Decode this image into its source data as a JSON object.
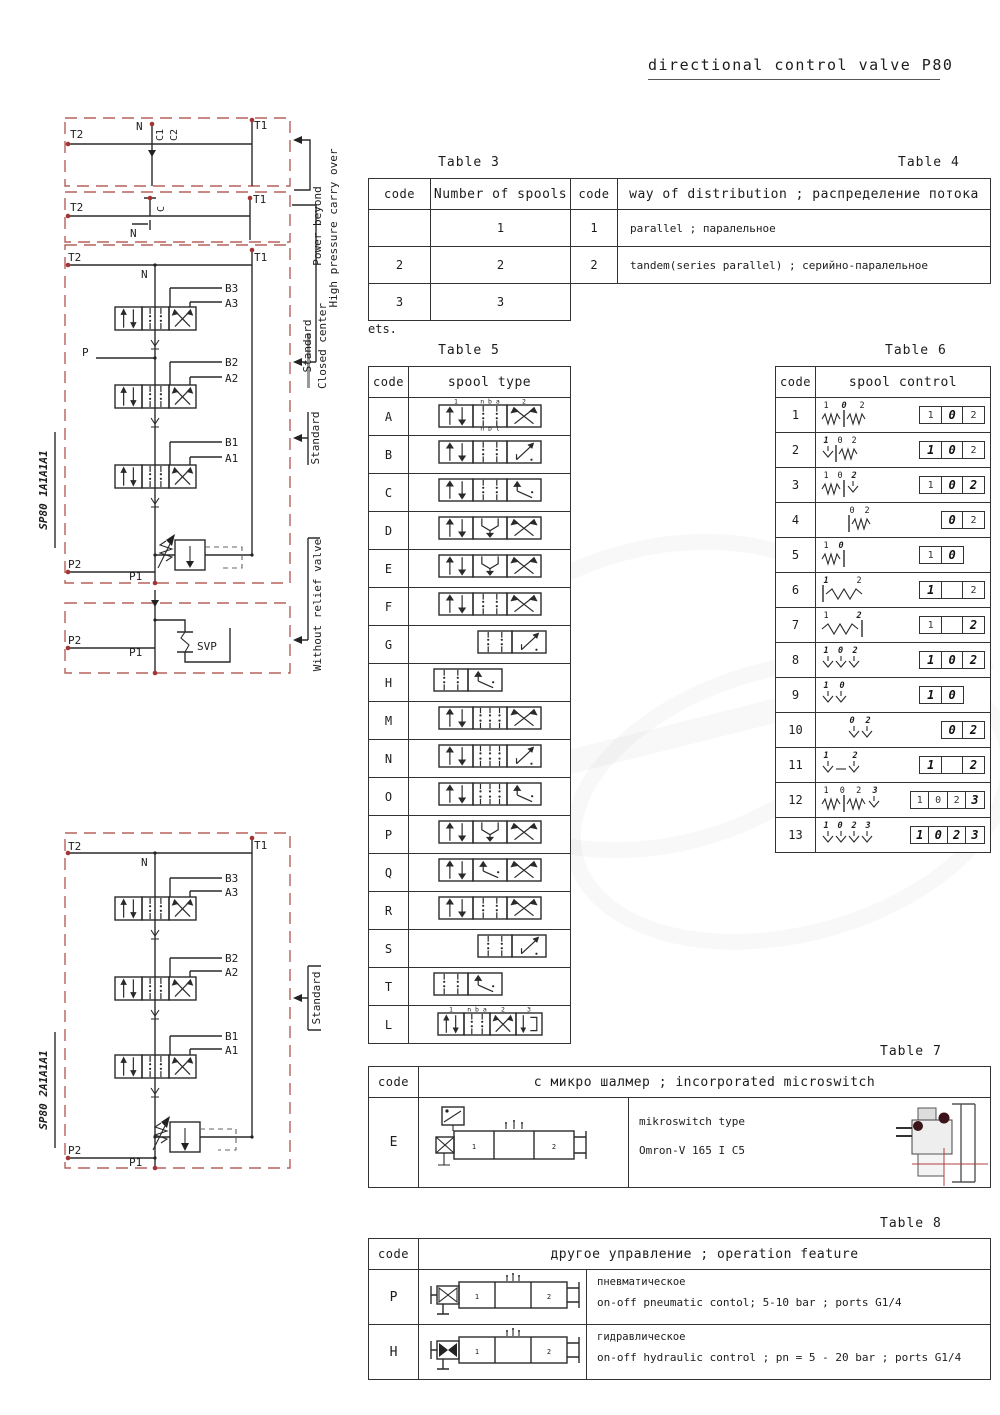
{
  "title": "directional control valve P80",
  "tables": {
    "t3": {
      "label": "Table 3",
      "headers": [
        "code",
        "Number of spools"
      ],
      "rows": [
        [
          "",
          "1"
        ],
        [
          "2",
          "2"
        ],
        [
          "3",
          "3"
        ]
      ],
      "note": "ets."
    },
    "t4": {
      "label": "Table 4",
      "headers": [
        "code",
        "way of distribution ; распределение потока"
      ],
      "rows": [
        [
          "1",
          "parallel ; паралельное"
        ],
        [
          "2",
          "tandem(series parallel) ; серийно-паралельное"
        ]
      ]
    },
    "t5": {
      "label": "Table 5",
      "headers": [
        "code",
        "spool type"
      ],
      "rows": [
        {
          "code": "A",
          "cells": [
            "P",
            "O",
            "X"
          ],
          "top": [
            "1",
            "n b a",
            "2"
          ],
          "bottom": [
            "",
            "n p t",
            ""
          ]
        },
        {
          "code": "B",
          "cells": [
            "P",
            "O",
            "Z"
          ]
        },
        {
          "code": "C",
          "cells": [
            "P",
            "O",
            "N"
          ]
        },
        {
          "code": "D",
          "cells": [
            "P",
            "U",
            "X"
          ]
        },
        {
          "code": "E",
          "cells": [
            "P",
            "U",
            "X"
          ]
        },
        {
          "code": "F",
          "cells": [
            "P",
            "O",
            "X"
          ]
        },
        {
          "code": "G",
          "cells": [
            "O",
            "Z"
          ],
          "offset": 1
        },
        {
          "code": "H",
          "cells": [
            "O",
            "N"
          ],
          "offset": -1
        },
        {
          "code": "M",
          "cells": [
            "P",
            "O6",
            "X"
          ]
        },
        {
          "code": "N",
          "cells": [
            "P",
            "O6",
            "Z"
          ]
        },
        {
          "code": "O",
          "cells": [
            "P",
            "O6",
            "N"
          ]
        },
        {
          "code": "P",
          "cells": [
            "P",
            "U",
            "X"
          ]
        },
        {
          "code": "Q",
          "cells": [
            "P",
            "N",
            "X"
          ]
        },
        {
          "code": "R",
          "cells": [
            "P",
            "O",
            "X"
          ]
        },
        {
          "code": "S",
          "cells": [
            "O",
            "Z"
          ],
          "offset": 1
        },
        {
          "code": "T",
          "cells": [
            "O",
            "N"
          ],
          "offset": -1
        },
        {
          "code": "L",
          "cells": [
            "P",
            "O",
            "X",
            "F4"
          ],
          "top": [
            "1",
            "n b a",
            "2",
            "3"
          ]
        }
      ]
    },
    "t6": {
      "label": "Table 6",
      "headers": [
        "code",
        "spool control"
      ],
      "rows": [
        {
          "code": "1",
          "sym": [
            "spring",
            "bar",
            "spring"
          ],
          "labels": [
            {
              "t": "1"
            },
            {
              "t": "0",
              "b": 1
            },
            {
              "t": "2"
            }
          ],
          "boxes": [
            {
              "t": "1"
            },
            {
              "t": "0",
              "b": 1
            },
            {
              "t": "2"
            }
          ]
        },
        {
          "code": "2",
          "sym": [
            "detent",
            "bar",
            "spring"
          ],
          "labels": [
            {
              "t": "1",
              "b": 1
            },
            {
              "t": "0"
            },
            {
              "t": "2"
            }
          ],
          "boxes": [
            {
              "t": "1",
              "b": 1
            },
            {
              "t": "0",
              "b": 1
            },
            {
              "t": "2"
            }
          ]
        },
        {
          "code": "3",
          "sym": [
            "spring",
            "bar",
            "detent"
          ],
          "labels": [
            {
              "t": "1"
            },
            {
              "t": "0"
            },
            {
              "t": "2",
              "b": 1
            }
          ],
          "boxes": [
            {
              "t": "1"
            },
            {
              "t": "0",
              "b": 1
            },
            {
              "t": "2",
              "b": 1
            }
          ]
        },
        {
          "code": "4",
          "sym": [
            "bar",
            "spring"
          ],
          "pad": 26,
          "labels": [
            {
              "t": "0"
            },
            {
              "t": "2"
            }
          ],
          "boxes": [
            {
              "s": 1
            },
            {
              "t": "0",
              "b": 1
            },
            {
              "t": "2"
            }
          ]
        },
        {
          "code": "5",
          "sym": [
            "spring",
            "bar"
          ],
          "labels": [
            {
              "t": "1"
            },
            {
              "t": "0",
              "b": 1
            }
          ],
          "boxes": [
            {
              "t": "1"
            },
            {
              "t": "0",
              "b": 1
            },
            {
              "s": 1
            }
          ]
        },
        {
          "code": "6",
          "sym": [
            "bar",
            "longspring"
          ],
          "labels": [
            {
              "t": "1",
              "b": 1
            },
            {
              "t": "2"
            }
          ],
          "boxes": [
            {
              "t": "1",
              "b": 1
            },
            {
              "t": ""
            },
            {
              "t": "2"
            }
          ]
        },
        {
          "code": "7",
          "sym": [
            "longspring",
            "bar"
          ],
          "labels": [
            {
              "t": "1"
            },
            {
              "t": "2",
              "b": 1
            }
          ],
          "boxes": [
            {
              "t": "1"
            },
            {
              "t": ""
            },
            {
              "t": "2",
              "b": 1
            }
          ]
        },
        {
          "code": "8",
          "sym": [
            "detent",
            "detent",
            "detent"
          ],
          "labels": [
            {
              "t": "1",
              "b": 1
            },
            {
              "t": "0",
              "b": 1
            },
            {
              "t": "2",
              "b": 1
            }
          ],
          "boxes": [
            {
              "t": "1",
              "b": 1
            },
            {
              "t": "0",
              "b": 1
            },
            {
              "t": "2",
              "b": 1
            }
          ]
        },
        {
          "code": "9",
          "sym": [
            "detent",
            "detent"
          ],
          "labels": [
            {
              "t": "1",
              "b": 1
            },
            {
              "t": "0",
              "b": 1
            }
          ],
          "boxes": [
            {
              "t": "1",
              "b": 1
            },
            {
              "t": "0",
              "b": 1
            },
            {
              "s": 1
            }
          ]
        },
        {
          "code": "10",
          "sym": [
            "detent",
            "detent"
          ],
          "pad": 26,
          "labels": [
            {
              "t": "0",
              "b": 1
            },
            {
              "t": "2",
              "b": 1
            }
          ],
          "boxes": [
            {
              "s": 1
            },
            {
              "t": "0",
              "b": 1
            },
            {
              "t": "2",
              "b": 1
            }
          ]
        },
        {
          "code": "11",
          "sym": [
            "detent",
            "dash",
            "detent"
          ],
          "labels": [
            {
              "t": "1",
              "b": 1
            },
            {
              "t": "2",
              "b": 1
            }
          ],
          "boxes": [
            {
              "t": "1",
              "b": 1
            },
            {
              "t": ""
            },
            {
              "t": "2",
              "b": 1
            }
          ]
        },
        {
          "code": "12",
          "sym": [
            "spring",
            "bar",
            "spring",
            "detent"
          ],
          "labels": [
            {
              "t": "1"
            },
            {
              "t": "0"
            },
            {
              "t": "2"
            },
            {
              "t": "3",
              "b": 1
            }
          ],
          "boxes": [
            {
              "t": "1"
            },
            {
              "t": "0"
            },
            {
              "t": "2"
            },
            {
              "t": "3",
              "b": 1
            }
          ]
        },
        {
          "code": "13",
          "sym": [
            "detent",
            "detent",
            "detent",
            "detent"
          ],
          "labels": [
            {
              "t": "1",
              "b": 1
            },
            {
              "t": "0",
              "b": 1
            },
            {
              "t": "2",
              "b": 1
            },
            {
              "t": "3",
              "b": 1
            }
          ],
          "boxes": [
            {
              "t": "1",
              "b": 1
            },
            {
              "t": "0",
              "b": 1
            },
            {
              "t": "2",
              "b": 1
            },
            {
              "t": "3",
              "b": 1
            }
          ]
        }
      ]
    },
    "t7": {
      "label": "Table 7",
      "header_code": "code",
      "header_title": "с микро шалмер ; incorporated microswitch",
      "code": "E",
      "text1": "mikroswitch type",
      "text2": "Omron-V 165 I C5"
    },
    "t8": {
      "label": "Table 8",
      "header_code": "code",
      "header_title": "другое управление ; operation feature",
      "rows": [
        {
          "code": "P",
          "ru": "пневматическое",
          "en": "on-off pneumatic contol; 5-10 bar ; ports G1/4"
        },
        {
          "code": "H",
          "ru": "гидравлическое",
          "en": "on-off hydraulic control ; pn = 5 - 20 bar ; ports G1/4"
        }
      ]
    }
  },
  "diagram": {
    "block1": {
      "t2": "T2",
      "n": "N",
      "c1": "C1",
      "c2": "C2",
      "t1": "T1"
    },
    "block2": {
      "t2": "T2",
      "c": "C",
      "n": "N",
      "t1": "T1"
    },
    "stack1": {
      "model": "SP80 1A1A1A1",
      "t2": "T2",
      "n": "N",
      "t1": "T1",
      "b3": "B3",
      "a3": "A3",
      "b2": "B2",
      "a2": "A2",
      "b1": "B1",
      "a1": "A1",
      "p": "P",
      "p2": "P2",
      "p1": "P1"
    },
    "norelief": {
      "svp": "SVP",
      "p2": "P2",
      "p1": "P1"
    },
    "stack2": {
      "model": "SP80 2A1A1A1",
      "t2": "T2",
      "n": "N",
      "t1": "T1",
      "b3": "B3",
      "a3": "A3",
      "b2": "B2",
      "a2": "A2",
      "b1": "B1",
      "a1": "A1",
      "p2": "P2",
      "p1": "P1"
    },
    "ann": {
      "power_beyond": "Power beyond",
      "carry_over": "High pressure carry over",
      "standard_a": "Standard",
      "closed_center": "Closed center",
      "standard_b": "Standard",
      "without_relief": "Without relief valve",
      "standard_c": "Standard"
    }
  },
  "colors": {
    "accent_red": "#b5605c",
    "dot_red": "#a33434",
    "line": "#2a2a2a"
  }
}
